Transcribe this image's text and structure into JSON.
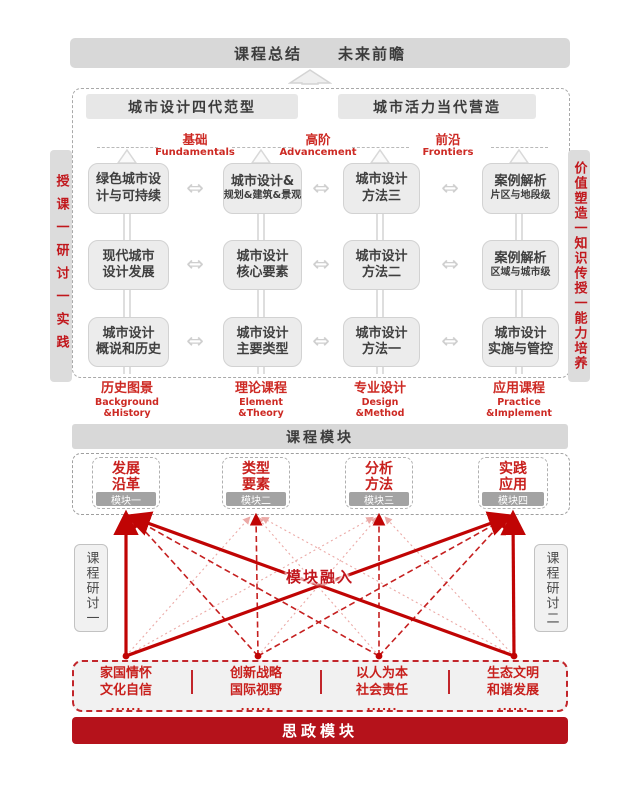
{
  "colors": {
    "accent_red": "#cd2a24",
    "deep_red": "#b5121b",
    "line_red": "#c00404",
    "pink_line": "#eba9a6",
    "bar_gray": "#d8d8d8",
    "box_gray": "#ececec",
    "tab_gray": "#a3a3a3",
    "text_dark": "#3b3b3b"
  },
  "icons": {
    "double_arrow": "⇔"
  },
  "top_bar": {
    "left": "课程总结",
    "right": "未来前瞻"
  },
  "paradigm_headers": {
    "left": "城市设计四代范型",
    "right": "城市活力当代营造"
  },
  "sidebars": {
    "left": "授课一研讨一实践",
    "right": "价值塑造一知识传授一能力培养"
  },
  "level_labels": [
    {
      "zh": "基础",
      "en": "Fundamentals"
    },
    {
      "zh": "高阶",
      "en": "Advancement"
    },
    {
      "zh": "前沿",
      "en": "Frontiers"
    }
  ],
  "grid": {
    "rows": [
      [
        {
          "line1": "绿色城市设",
          "line2": "计与可持续"
        },
        {
          "line1": "城市设计&",
          "line2": "规划&建筑&景观"
        },
        {
          "line1": "城市设计",
          "line2": "方法三"
        },
        {
          "line1": "案例解析",
          "line2": "片区与地段级"
        }
      ],
      [
        {
          "line1": "现代城市",
          "line2": "设计发展"
        },
        {
          "line1": "城市设计",
          "line2": "核心要素"
        },
        {
          "line1": "城市设计",
          "line2": "方法二"
        },
        {
          "line1": "案例解析",
          "line2": "区域与城市级"
        }
      ],
      [
        {
          "line1": "城市设计",
          "line2": "概说和历史"
        },
        {
          "line1": "城市设计",
          "line2": "主要类型"
        },
        {
          "line1": "城市设计",
          "line2": "方法一"
        },
        {
          "line1": "城市设计",
          "line2": "实施与管控"
        }
      ]
    ]
  },
  "column_footers": [
    {
      "zh": "历史图景",
      "en1": "Background",
      "en2": "&History"
    },
    {
      "zh": "理论课程",
      "en1": "Element",
      "en2": "&Theory"
    },
    {
      "zh": "专业设计",
      "en1": "Design",
      "en2": "&Method"
    },
    {
      "zh": "应用课程",
      "en1": "Practice",
      "en2": "&Implement"
    }
  ],
  "course_module_bar": "课程模块",
  "modules": [
    {
      "line1": "发展",
      "line2": "沿革",
      "tag": "模块一"
    },
    {
      "line1": "类型",
      "line2": "要素",
      "tag": "模块二"
    },
    {
      "line1": "分析",
      "line2": "方法",
      "tag": "模块三"
    },
    {
      "line1": "实践",
      "line2": "应用",
      "tag": "模块四"
    }
  ],
  "seminars": {
    "left": "课程研讨一",
    "right": "课程研讨二"
  },
  "integration_label": "模块融入",
  "ideology": {
    "items": [
      {
        "line1": "家国情怀",
        "line2": "文化自信",
        "dots": "......"
      },
      {
        "line1": "创新战略",
        "line2": "国际视野",
        "dots": "......"
      },
      {
        "line1": "以人为本",
        "line2": "社会责任",
        "dots": "......"
      },
      {
        "line1": "生态文明",
        "line2": "和谐发展",
        "dots": "......"
      }
    ],
    "bar_label": "思政模块"
  }
}
